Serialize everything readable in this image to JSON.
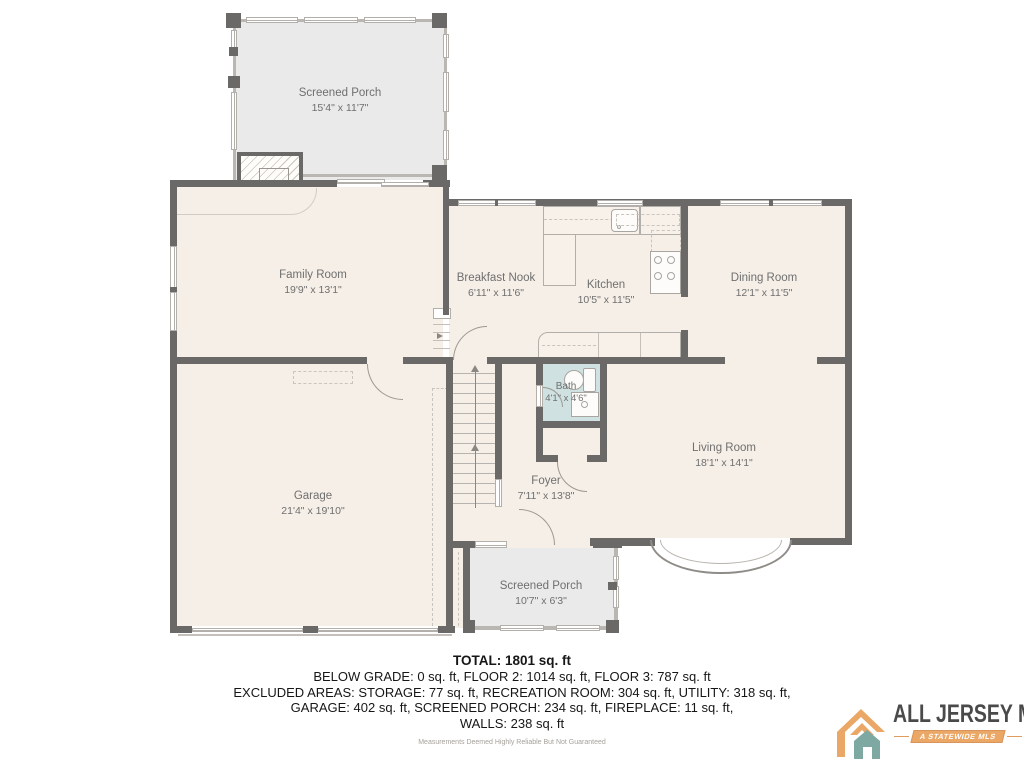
{
  "plan": {
    "rooms": [
      {
        "id": "screened-porch-top",
        "name": "Screened Porch",
        "dims": "15'4\" x 11'7\""
      },
      {
        "id": "family-room",
        "name": "Family Room",
        "dims": "19'9\" x 13'1\""
      },
      {
        "id": "breakfast-nook",
        "name": "Breakfast Nook",
        "dims": "6'11\" x 11'6\""
      },
      {
        "id": "kitchen",
        "name": "Kitchen",
        "dims": "10'5\" x 11'5\""
      },
      {
        "id": "dining-room",
        "name": "Dining Room",
        "dims": "12'1\" x 11'5\""
      },
      {
        "id": "bath",
        "name": "Bath",
        "dims": "4'1\" x 4'6\""
      },
      {
        "id": "living-room",
        "name": "Living Room",
        "dims": "18'1\" x 14'1\""
      },
      {
        "id": "foyer",
        "name": "Foyer",
        "dims": "7'11\" x 13'8\""
      },
      {
        "id": "garage",
        "name": "Garage",
        "dims": "21'4\" x 19'10\""
      },
      {
        "id": "screened-porch-bottom",
        "name": "Screened Porch",
        "dims": "10'7\" x 6'3\""
      }
    ],
    "colors": {
      "floor": "#f6efe7",
      "porch": "#e9eae9",
      "wall": "#6b6968",
      "bath": "#cfe1e0",
      "label_text": "#6f6f6f"
    }
  },
  "summary": {
    "total": "TOTAL: 1801 sq. ft",
    "line1": "BELOW GRADE: 0 sq. ft, FLOOR 2: 1014 sq. ft, FLOOR 3: 787 sq. ft",
    "line2": "EXCLUDED AREAS: STORAGE: 77 sq. ft, RECREATION ROOM: 304 sq. ft, UTILITY: 318 sq. ft,",
    "line3": "GARAGE: 402 sq. ft, SCREENED PORCH: 234 sq. ft, FIREPLACE: 11 sq. ft,",
    "line4": "WALLS: 238 sq. ft",
    "disclaimer": "Measurements Deemed Highly Reliable But Not Guaranteed"
  },
  "logo": {
    "name": "ALL JERSEY MLS",
    "tagline": "A STATEWIDE MLS",
    "colors": {
      "orange": "#eaa765",
      "teal": "#7ea9a3",
      "text": "#4b4a4a"
    }
  }
}
